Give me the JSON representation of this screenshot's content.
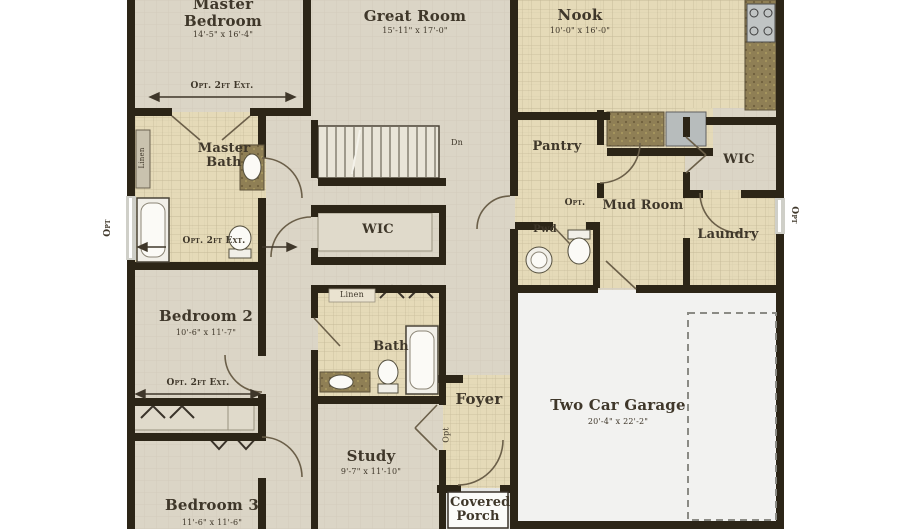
{
  "plan": {
    "rooms": {
      "master_bedroom": {
        "name": "Master Bedroom",
        "dims": "14'-5\" x 16'-4\""
      },
      "great_room": {
        "name": "Great Room",
        "dims": "15'-11\" x 17'-0\""
      },
      "nook": {
        "name": "Nook",
        "dims": "10'-0\" x 16'-0\""
      },
      "master_bath": {
        "name": "Master Bath"
      },
      "wic_hall": {
        "name": "WIC"
      },
      "pantry": {
        "name": "Pantry"
      },
      "mud_room": {
        "name": "Mud Room"
      },
      "wic_rear": {
        "name": "WIC"
      },
      "laundry": {
        "name": "Laundry"
      },
      "powder": {
        "name": "Pwd"
      },
      "bedroom2": {
        "name": "Bedroom 2",
        "dims": "10'-6\" x 11'-7\""
      },
      "bath2": {
        "name": "Bath"
      },
      "linen_bath": {
        "name": "Linen"
      },
      "linen_master": {
        "name": "Linen"
      },
      "bedroom3": {
        "name": "Bedroom 3",
        "dims": "11'-6\" x 11'-6\""
      },
      "study": {
        "name": "Study",
        "dims": "9'-7\" x 11'-10\""
      },
      "foyer": {
        "name": "Foyer"
      },
      "covered_porch": {
        "name": "Covered Porch"
      },
      "garage": {
        "name": "Two Car Garage",
        "dims": "20'-4\" x 22'-2\""
      }
    },
    "annotations": {
      "opt_2ft_ext": "Opt. 2ft Ext.",
      "opt": "Opt",
      "opt_dot": "Opt.",
      "down": "Dn"
    },
    "colors": {
      "walls": "#2c2517",
      "carpet": "#dbd5c6",
      "tile": "#e5dab8",
      "garage_floor": "#f2f2f0",
      "text": "#3f372a"
    }
  }
}
